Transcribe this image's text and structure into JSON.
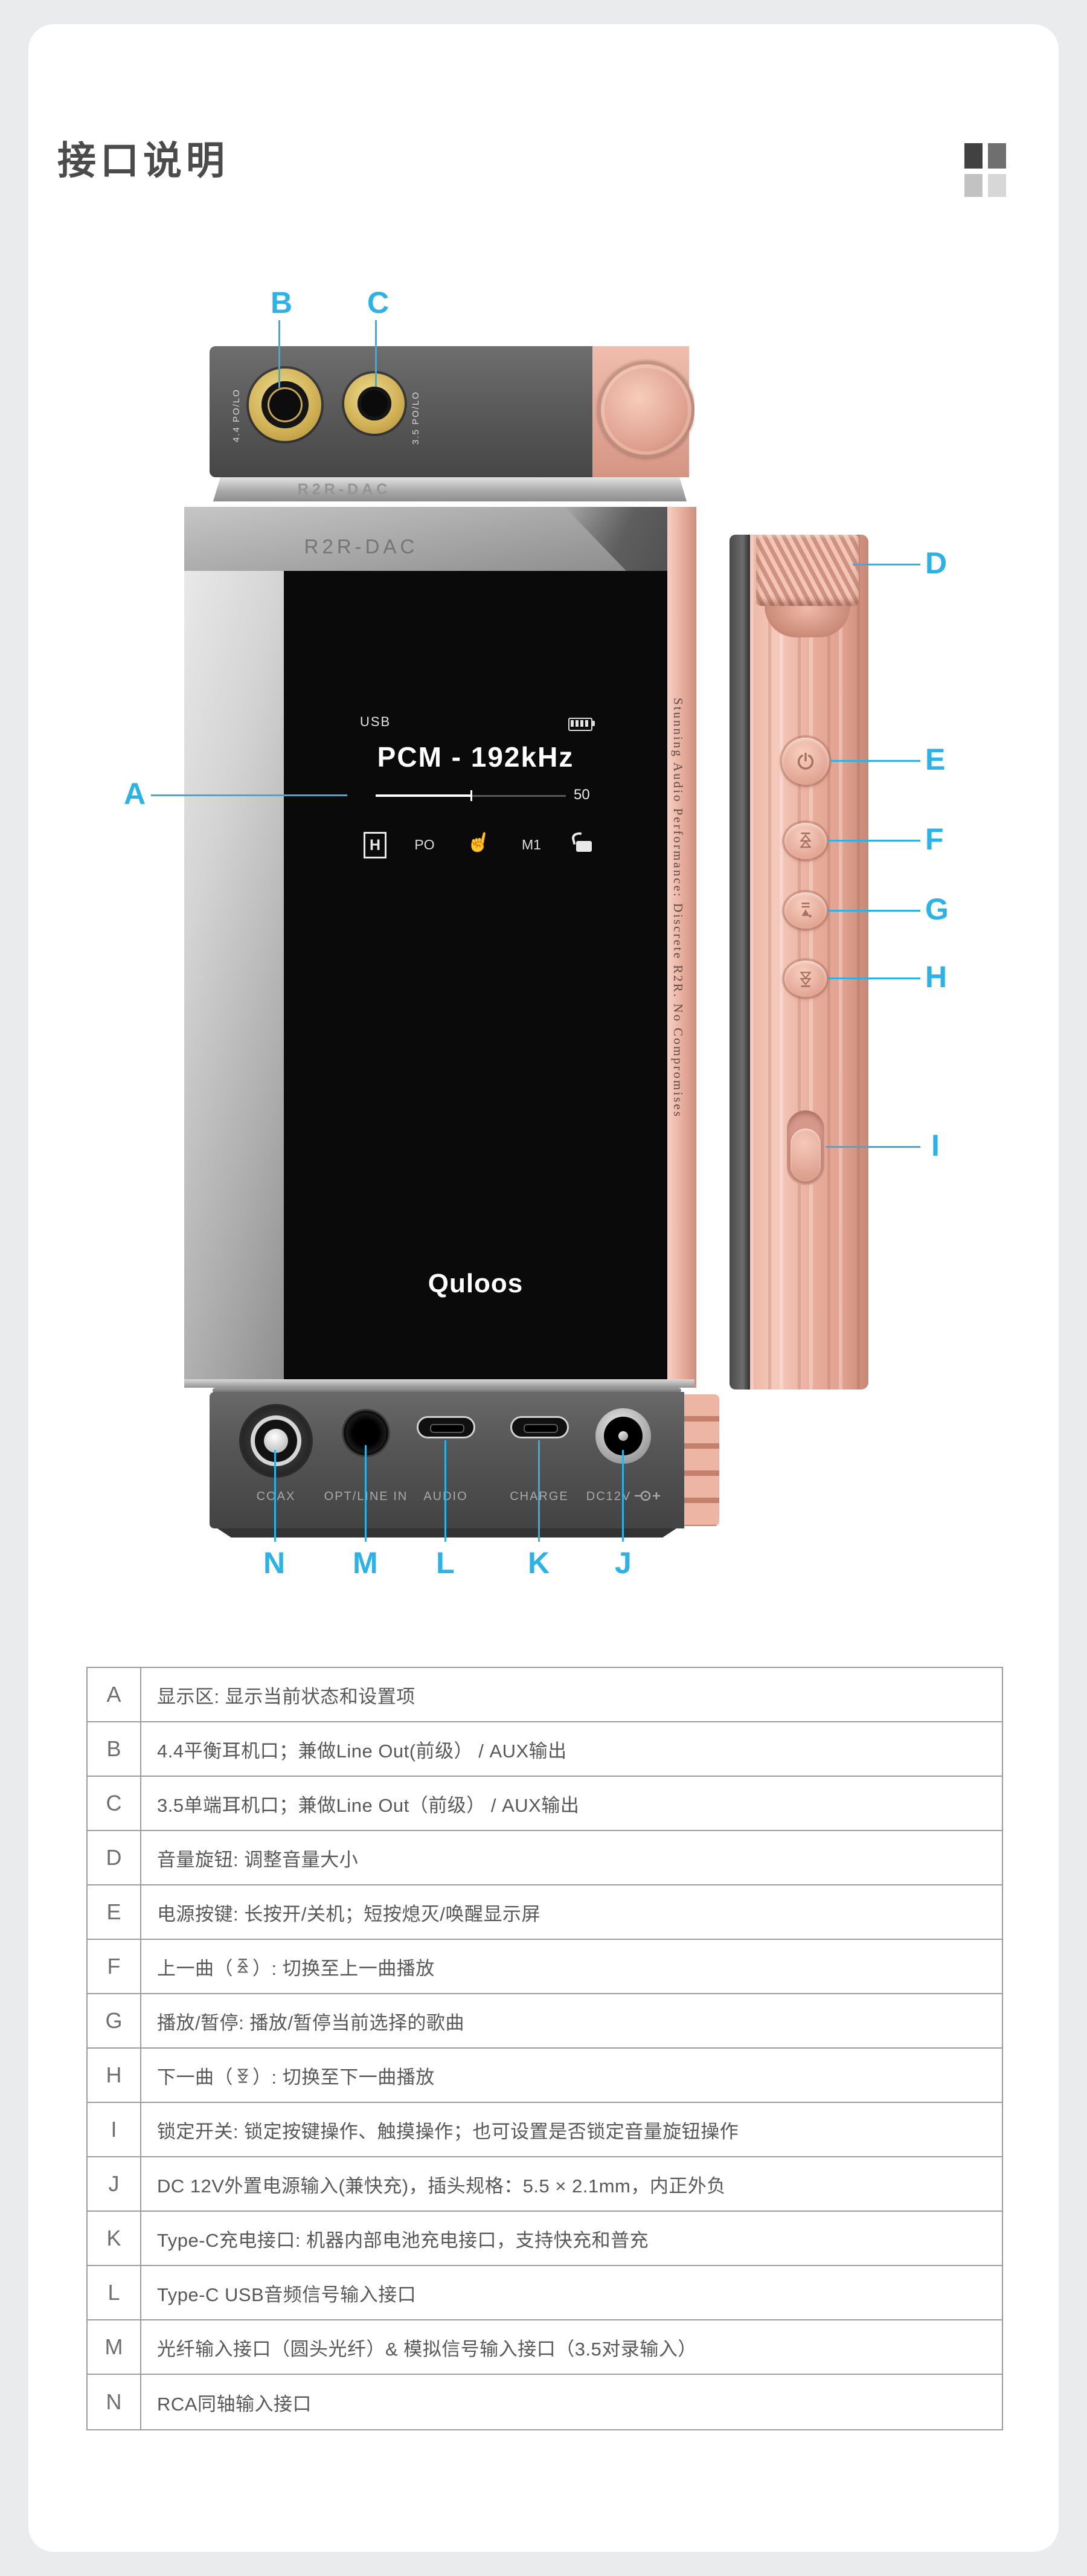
{
  "title": "接口说明",
  "accent_color": "#2bb3e8",
  "device": {
    "top_view": {
      "engraving": "R2R-DAC",
      "jack_44_label": "4.4 PO/LO",
      "jack_35_label": "3.5 PO/LO"
    },
    "front_view": {
      "engraving": "R2R-DAC",
      "edge_slogan": "Stunning Audio Performance: Discrete R2R. No Compromises",
      "screen": {
        "source": "USB",
        "format": "PCM - 192kHz",
        "volume": "50",
        "badge_gain": "H",
        "badge_output": "PO",
        "badge_memory": "M1",
        "touch_glyph": "☝",
        "logo": "Quloos"
      }
    },
    "bottom_view": {
      "ports": [
        "COAX",
        "OPT/LINE IN",
        "AUDIO",
        "CHARGE",
        "DC12V"
      ],
      "dc_polarity_plus": "+"
    }
  },
  "callouts": {
    "A": "A",
    "B": "B",
    "C": "C",
    "D": "D",
    "E": "E",
    "F": "F",
    "G": "G",
    "H": "H",
    "I": "I",
    "J": "J",
    "K": "K",
    "L": "L",
    "M": "M",
    "N": "N"
  },
  "table": {
    "rows": [
      {
        "key": "A",
        "text": "显示区: 显示当前状态和设置项"
      },
      {
        "key": "B",
        "text": "4.4平衡耳机口；兼做Line Out(前级） / AUX输出"
      },
      {
        "key": "C",
        "text": "3.5单端耳机口；兼做Line Out（前级） / AUX输出"
      },
      {
        "key": "D",
        "text": "音量旋钮: 调整音量大小"
      },
      {
        "key": "E",
        "text": "电源按键: 长按开/关机；短按熄灭/唤醒显示屏"
      },
      {
        "key": "F",
        "pre": "上一曲（",
        "icon": "prev-track-icon",
        "post": "）: 切换至上一曲播放"
      },
      {
        "key": "G",
        "text": "播放/暂停: 播放/暂停当前选择的歌曲"
      },
      {
        "key": "H",
        "pre": "下一曲（",
        "icon": "next-track-icon",
        "post": "）: 切换至下一曲播放"
      },
      {
        "key": "I",
        "text": "锁定开关: 锁定按键操作、触摸操作；也可设置是否锁定音量旋钮操作"
      },
      {
        "key": "J",
        "text": "DC 12V外置电源输入(兼快充)，插头规格：5.5 × 2.1mm，内正外负"
      },
      {
        "key": "K",
        "text": "Type-C充电接口: 机器内部电池充电接口，支持快充和普充"
      },
      {
        "key": "L",
        "text": "Type-C USB音频信号输入接口"
      },
      {
        "key": "M",
        "text": "光纤输入接口（圆头光纤）& 模拟信号输入接口（3.5对录输入）"
      },
      {
        "key": "N",
        "text": "RCA同轴输入接口"
      }
    ]
  }
}
